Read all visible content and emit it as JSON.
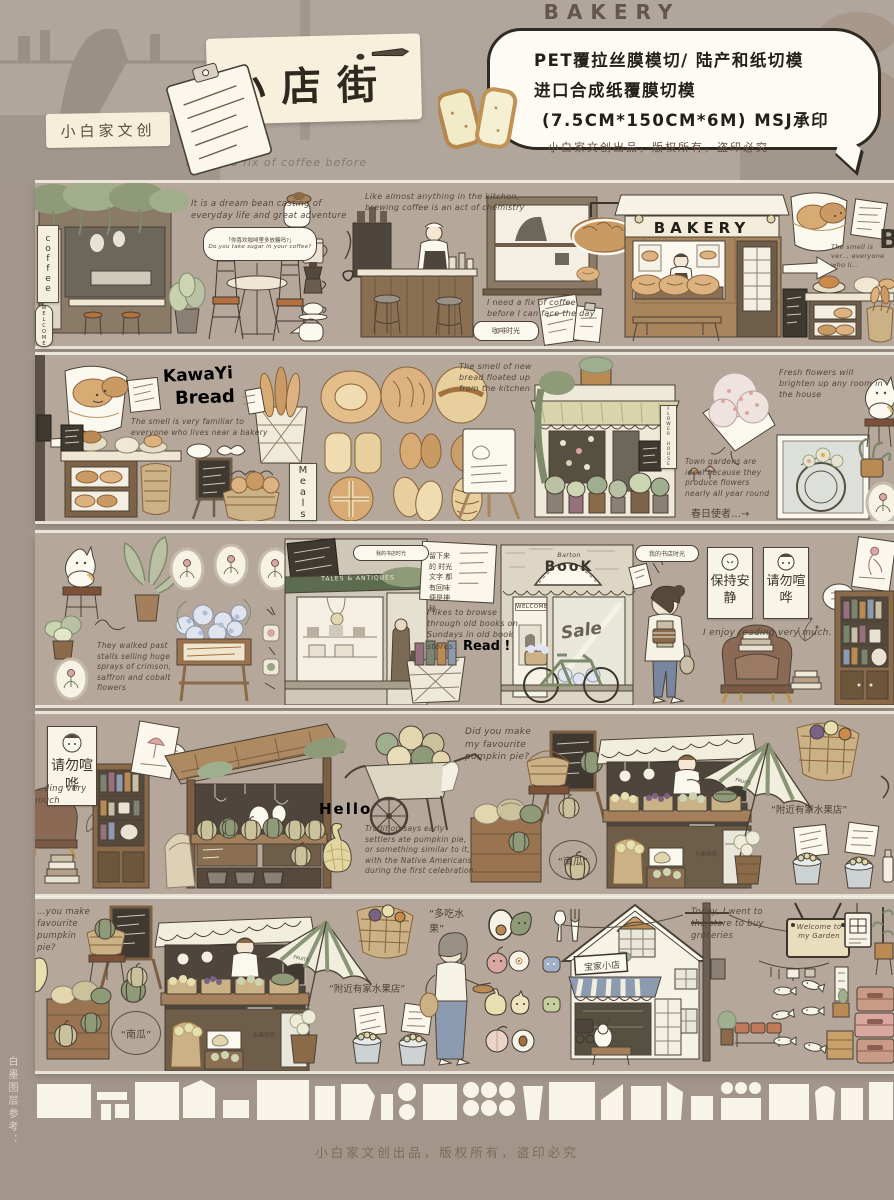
{
  "colors": {
    "backdrop": "#a2968b",
    "strip_background": "#b5a89b",
    "card_cream": "#f6f0dd",
    "ink": "#2f2a23",
    "wood_brown": "#a8855d",
    "leaf_green": "#a2ad8c"
  },
  "header": {
    "brand_label": "小白家文创",
    "title": "小店街",
    "backdrop_sign": "BAKERY",
    "bubble_lines": [
      "PET覆拉丝膜模切/ 陆产和纸切模",
      "进口合成纸覆膜切模",
      "(7.5CM*150CM*6M) MSJ承印"
    ],
    "publisher_note": "小白家文创出品，版权所有，盗印必究",
    "bg_script": "I need a fix of coffee before"
  },
  "strip_coffee": {
    "coffee_sign": "coffee",
    "welcome_ribbon": "WELCOME",
    "script_dream": "It is a dream bean casting of everyday life and great adventure",
    "bubble_cn": "「你喜欢咖啡里多放糖吗?」",
    "bubble_en": "Do you take sugar in your coffee?",
    "script_kitchen": "Like almost anything in the kitchen, brewing coffee is an act of chemistry",
    "script_fix": "I need a fix of coffee before I can face the day",
    "coffee_tag": "咖啡时光",
    "bakery_sign": "BAKERY",
    "edge_script": "The smell is ver… everyone who li…",
    "edge_letter": "B"
  },
  "strip_bread": {
    "heading_line1": "KawaYi",
    "heading_line2": "Bread",
    "script_smell": "The smell is very familiar to everyone who lives near a bakery",
    "meals_sign": "Meals",
    "script_new_bread": "The smell of new bread floated up from the kitchen",
    "flower_sign": "FLOWER HOUSE",
    "script_fresh": "Fresh flowers will brighten up any room in the house",
    "script_gardens": "Town gardens are ideal because they produce flowers nearly all year round",
    "script_cn": "春日使者…→"
  },
  "strip_books": {
    "note_cn": "留下来的 时光文字 都有回味 便是神秘",
    "script_walked": "They walked past stalls selling huge sprays of crimson, saffron and cobalt flowers",
    "antique_sign": "TALES & ANTIQUES",
    "script_browse": "I likes to browse through old books on Sundays in old book stores.",
    "read_tag": "Read !",
    "book_sign_small": "Barton",
    "book_sign_big": "BooK",
    "welcome_sign": "WELCOME",
    "sale_script": "Sale",
    "girl_bubble": "我的书店时光",
    "poster_quiet": "保持安静",
    "poster_hush": "请勿喧哗",
    "script_enjoy": "I enjoy reading very much."
  },
  "strip_market": {
    "poster_hush": "请勿喧哗",
    "edge_script": "…ding very much",
    "hello": "Hello",
    "script_tradition": "Tradition says early settlers ate pumpkin pie, or something similar to it, with the Native Americans during the first celebration",
    "script_pie": "Did you make my favourite pumpkin pie?",
    "pumpkin_stamp": "“南瓜”",
    "umbrella_label": "FRUITS",
    "script_fruit_shop": "“附近有家水果店”",
    "sale_card": "水果特卖"
  },
  "strip_garden": {
    "edge_script": "…you make favourite pumpkin pie?",
    "pumpkin_stamp": "“南瓜”",
    "script_fruit_shop": "“附近有家水果店”",
    "script_more_fruit": "“多吃水果”",
    "umbrella_label": "FRUITS",
    "shop_sign": "宝家小店",
    "script_today": "Today, I went to the store to buy groceries",
    "garden_sign": "Welcome to my Garden",
    "sale_card": "水果特卖"
  },
  "footer": {
    "white_layer_label": "白墨图层参考：",
    "note": "小白家文创出品，版权所有，盗印必究"
  }
}
